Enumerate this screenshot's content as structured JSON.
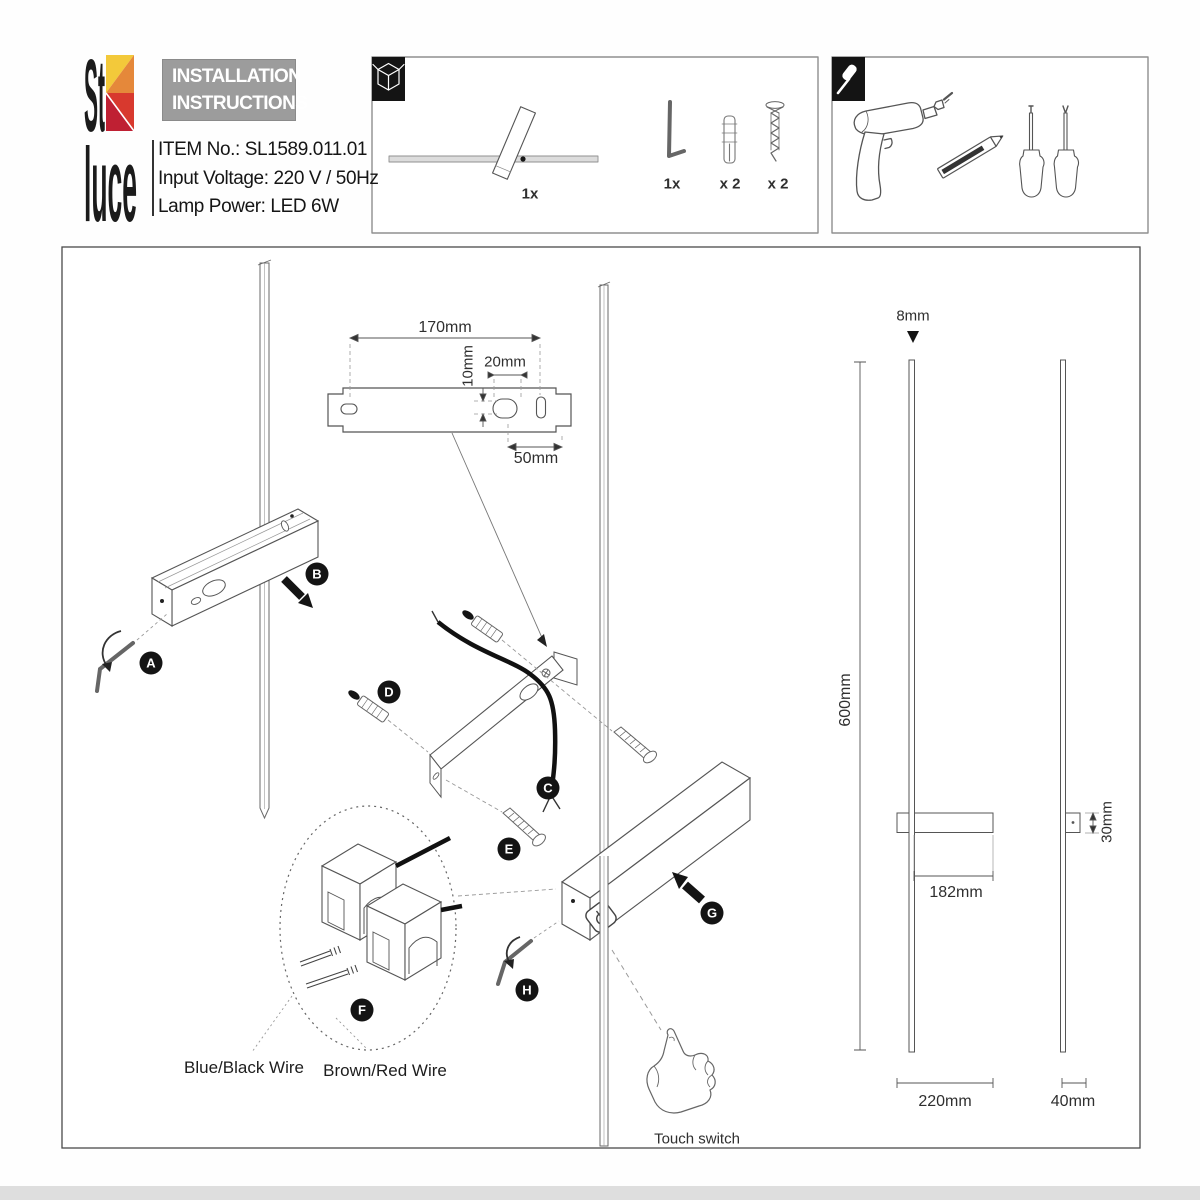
{
  "brand": {
    "logo_top": "St",
    "logo_bottom": "luce",
    "title_line1": "INSTALLATION",
    "title_line2": "INSTRUCTIONS",
    "item_no": "ITEM No.: SL1589.011.01",
    "input_voltage": "Input Voltage: 220 V / 50Hz",
    "lamp_power": "Lamp Power: LED 6W"
  },
  "package_box": {
    "lamp_qty": "1x",
    "hex_key_qty": "1x",
    "wall_plug_qty": "x 2",
    "screw_qty": "x 2"
  },
  "mounting_plate": {
    "width": "170mm",
    "hole_offset": "10mm",
    "hole_width": "20mm",
    "hole_to_edge": "50mm"
  },
  "steps": {
    "a": "A",
    "b": "B",
    "c": "C",
    "d": "D",
    "e": "E",
    "f": "F",
    "g": "G",
    "h": "H"
  },
  "wiring": {
    "blue_black": "Blue/Black Wire",
    "brown_red": "Brown/Red Wire"
  },
  "touch_switch_label": "Touch switch",
  "dimensions": {
    "rod_diameter": "8mm",
    "height": "600mm",
    "body_length": "182mm",
    "body_depth": "30mm",
    "overall_width": "220mm",
    "side_width": "40mm"
  },
  "colors": {
    "logo_yellow": "#f3c93a",
    "logo_orange": "#e5883a",
    "logo_red": "#d8392e",
    "logo_crimson": "#bf2033",
    "title_bg": "#9c9c9c",
    "line": "#4f4f4f"
  }
}
